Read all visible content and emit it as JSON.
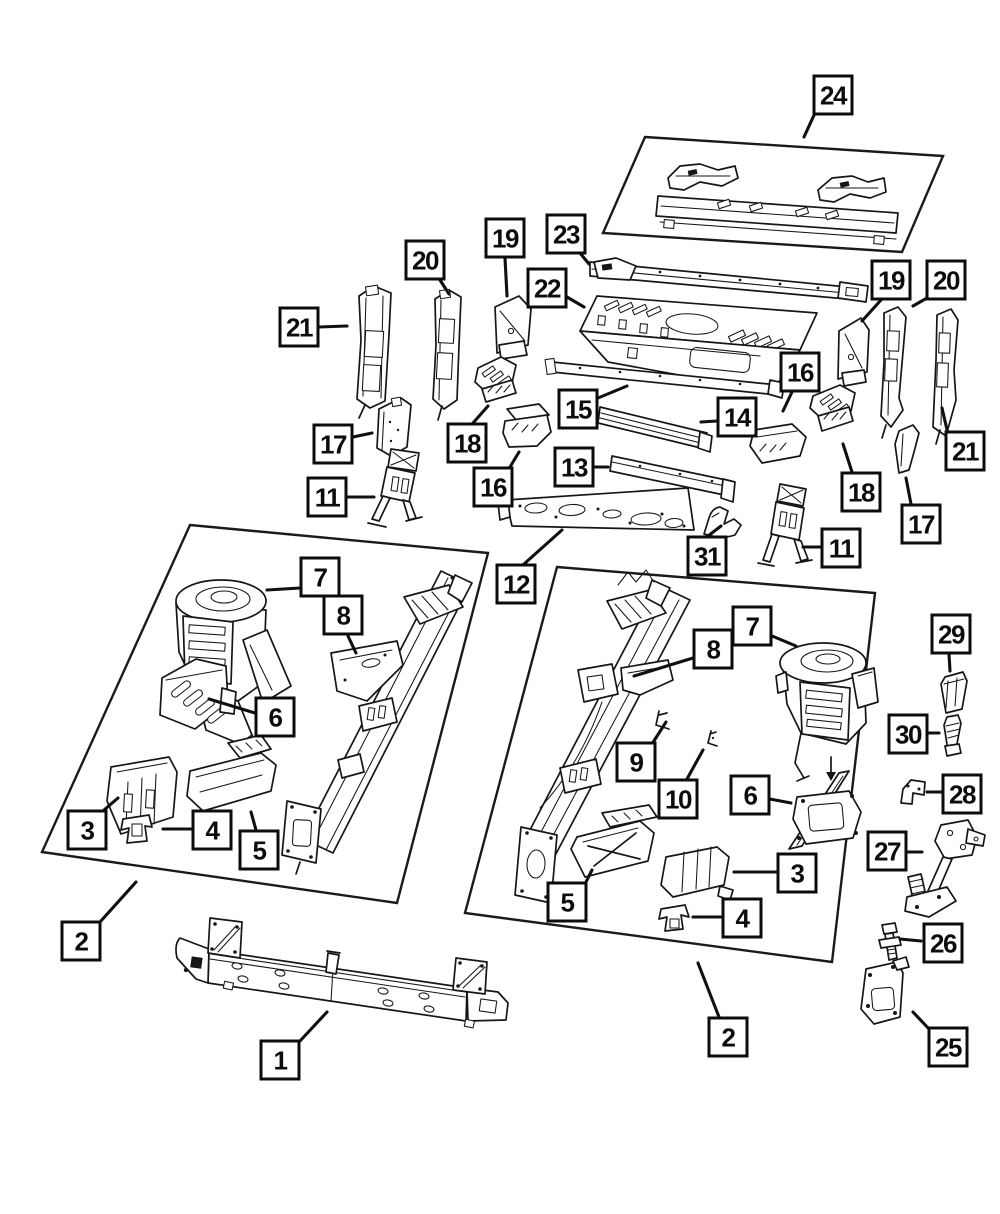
{
  "colors": {
    "ink": "#161616",
    "paper": "#ffffff",
    "callout_border": "#0c0c0c"
  },
  "callouts": [
    {
      "label": "24",
      "x": 833,
      "y": 95,
      "line": [
        815,
        113,
        804,
        137
      ]
    },
    {
      "label": "23",
      "x": 566,
      "y": 234,
      "line": [
        580,
        253,
        589,
        264
      ]
    },
    {
      "label": "19",
      "x": 505,
      "y": 238,
      "line": [
        505,
        258,
        507,
        296
      ]
    },
    {
      "label": "20",
      "x": 425,
      "y": 260,
      "line": [
        440,
        280,
        449,
        294
      ]
    },
    {
      "label": "21",
      "x": 299,
      "y": 327,
      "line": [
        319,
        327,
        347,
        326
      ]
    },
    {
      "label": "22",
      "x": 547,
      "y": 288,
      "line": [
        567,
        297,
        584,
        307
      ]
    },
    {
      "label": "17",
      "x": 333,
      "y": 444,
      "line": [
        353,
        437,
        372,
        433
      ]
    },
    {
      "label": "18",
      "x": 467,
      "y": 443,
      "line": [
        473,
        423,
        488,
        406
      ]
    },
    {
      "label": "16",
      "x": 493,
      "y": 487,
      "line": [
        510,
        467,
        519,
        452
      ]
    },
    {
      "label": "11",
      "x": 327,
      "y": 497,
      "line": [
        347,
        497,
        374,
        497
      ]
    },
    {
      "label": "15",
      "x": 578,
      "y": 409,
      "line": [
        598,
        398,
        627,
        386
      ]
    },
    {
      "label": "14",
      "x": 737,
      "y": 417,
      "line": [
        717,
        421,
        701,
        422
      ]
    },
    {
      "label": "13",
      "x": 574,
      "y": 467,
      "line": [
        594,
        467,
        608,
        467
      ]
    },
    {
      "label": "12",
      "x": 516,
      "y": 584,
      "line": [
        524,
        564,
        562,
        530
      ]
    },
    {
      "label": "31",
      "x": 707,
      "y": 556,
      "line": [
        708,
        536,
        721,
        526
      ]
    },
    {
      "label": "16",
      "x": 800,
      "y": 372,
      "line": [
        792,
        392,
        783,
        411
      ]
    },
    {
      "label": "18",
      "x": 861,
      "y": 492,
      "line": [
        852,
        472,
        843,
        444
      ]
    },
    {
      "label": "11",
      "x": 841,
      "y": 548,
      "line": [
        821,
        547,
        803,
        547
      ]
    },
    {
      "label": "19",
      "x": 891,
      "y": 280,
      "line": [
        881,
        300,
        862,
        321
      ]
    },
    {
      "label": "20",
      "x": 946,
      "y": 280,
      "line": [
        927,
        298,
        913,
        306
      ]
    },
    {
      "label": "21",
      "x": 965,
      "y": 451,
      "line": [
        948,
        434,
        942,
        408
      ]
    },
    {
      "label": "17",
      "x": 921,
      "y": 524,
      "line": [
        911,
        504,
        906,
        478
      ]
    },
    {
      "label": "7",
      "x": 320,
      "y": 577,
      "line": [
        300,
        588,
        267,
        590
      ]
    },
    {
      "label": "8",
      "x": 343,
      "y": 615,
      "line": [
        348,
        636,
        356,
        653
      ]
    },
    {
      "label": "6",
      "x": 275,
      "y": 717,
      "line": [
        255,
        713,
        209,
        699
      ]
    },
    {
      "label": "3",
      "x": 87,
      "y": 830,
      "line": [
        104,
        810,
        118,
        798
      ]
    },
    {
      "label": "4",
      "x": 212,
      "y": 830,
      "line": [
        192,
        829,
        163,
        829
      ]
    },
    {
      "label": "5",
      "x": 259,
      "y": 850,
      "line": [
        256,
        830,
        251,
        812
      ]
    },
    {
      "label": "2",
      "x": 81,
      "y": 941,
      "line": [
        100,
        922,
        136,
        882
      ]
    },
    {
      "label": "1",
      "x": 280,
      "y": 1060,
      "line": [
        300,
        1041,
        327,
        1012
      ]
    },
    {
      "label": "7",
      "x": 752,
      "y": 626,
      "line": [
        772,
        636,
        796,
        646
      ]
    },
    {
      "label": "8",
      "x": 713,
      "y": 649,
      "line": [
        693,
        658,
        634,
        676
      ]
    },
    {
      "label": "9",
      "x": 636,
      "y": 762,
      "line": [
        652,
        744,
        666,
        722
      ]
    },
    {
      "label": "10",
      "x": 678,
      "y": 799,
      "line": [
        687,
        779,
        703,
        750
      ]
    },
    {
      "label": "6",
      "x": 750,
      "y": 795,
      "line": [
        770,
        799,
        791,
        803
      ]
    },
    {
      "label": "5",
      "x": 567,
      "y": 902,
      "line": [
        585,
        884,
        592,
        870
      ]
    },
    {
      "label": "3",
      "x": 797,
      "y": 873,
      "line": [
        777,
        872,
        734,
        872
      ]
    },
    {
      "label": "4",
      "x": 742,
      "y": 918,
      "line": [
        722,
        917,
        693,
        917
      ]
    },
    {
      "label": "2",
      "x": 728,
      "y": 1037,
      "line": [
        719,
        1017,
        698,
        963
      ]
    },
    {
      "label": "29",
      "x": 951,
      "y": 634,
      "line": [
        949,
        654,
        950,
        671
      ]
    },
    {
      "label": "30",
      "x": 908,
      "y": 734,
      "line": [
        928,
        733,
        939,
        733
      ]
    },
    {
      "label": "28",
      "x": 962,
      "y": 794,
      "line": [
        942,
        792,
        927,
        792
      ]
    },
    {
      "label": "27",
      "x": 887,
      "y": 851,
      "line": [
        907,
        852,
        922,
        852
      ]
    },
    {
      "label": "26",
      "x": 943,
      "y": 943,
      "line": [
        921,
        941,
        900,
        939
      ]
    },
    {
      "label": "25",
      "x": 948,
      "y": 1047,
      "line": [
        929,
        1029,
        913,
        1012
      ]
    }
  ]
}
